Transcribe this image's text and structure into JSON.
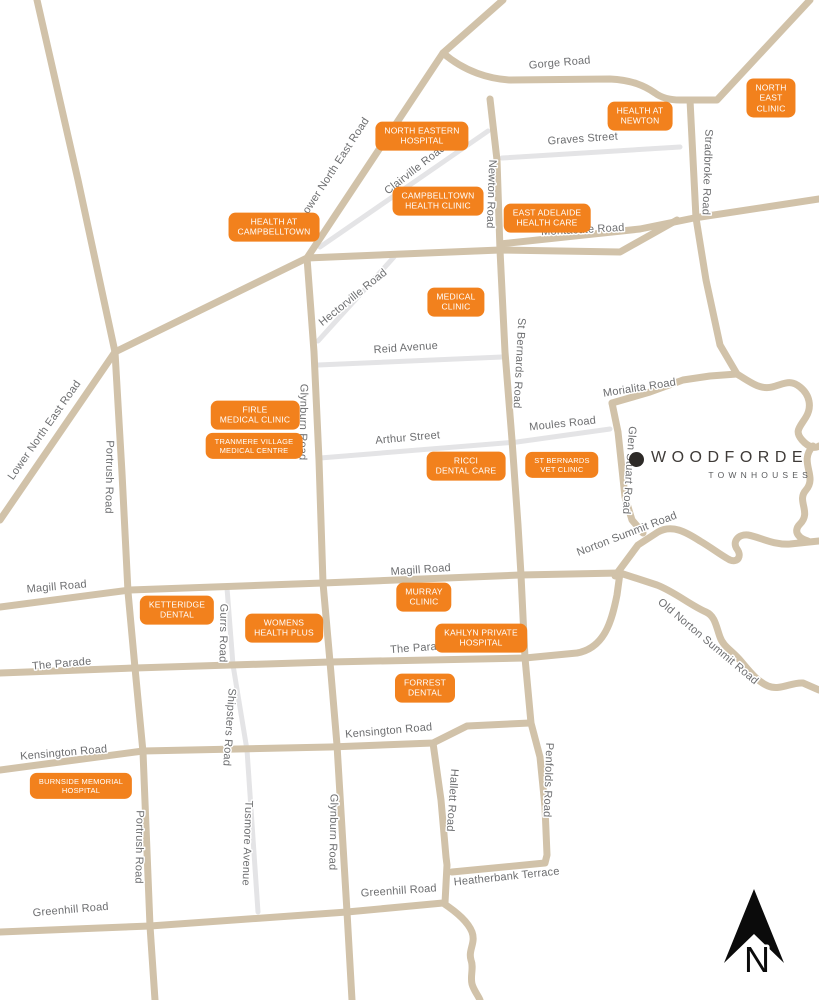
{
  "map": {
    "background_color": "#ffffff",
    "road_color": "#d1c2a9",
    "minor_road_color": "#e4e4e6",
    "road_label_color": "#6d6e70",
    "marker_color": "#f2811d",
    "marker_text_color": "#ffffff"
  },
  "logo": {
    "name": "WOODFORDE",
    "subtitle": "TOWNHOUSES"
  },
  "north_indicator": {
    "label": "N"
  },
  "road_labels": [
    {
      "id": "gorge-road",
      "text": "Gorge Road"
    },
    {
      "id": "graves-street",
      "text": "Graves Street"
    },
    {
      "id": "montacute-road",
      "text": "Montacute Road"
    },
    {
      "id": "clairville-road",
      "text": "Clairville Road"
    },
    {
      "id": "lower-north-east-road-upper",
      "text": "Lower North East Road"
    },
    {
      "id": "newton-road",
      "text": "Newton Road"
    },
    {
      "id": "stradbroke-road",
      "text": "Stradbroke Road"
    },
    {
      "id": "hectorville-road",
      "text": "Hectorville Road"
    },
    {
      "id": "reid-avenue",
      "text": "Reid Avenue"
    },
    {
      "id": "st-bernards-road",
      "text": "St Bernards Road"
    },
    {
      "id": "morialita-road",
      "text": "Morialita Road"
    },
    {
      "id": "moules-road",
      "text": "Moules Road"
    },
    {
      "id": "arthur-street",
      "text": "Arthur Street"
    },
    {
      "id": "glen-stuart-road",
      "text": "Glen Stuart Road"
    },
    {
      "id": "glynburn-road-upper",
      "text": "Glynburn Road"
    },
    {
      "id": "portrush-road-upper",
      "text": "Portrush Road"
    },
    {
      "id": "lower-north-east-road-lower",
      "text": "Lower North East Road"
    },
    {
      "id": "norton-summit-road",
      "text": "Norton Summit Road"
    },
    {
      "id": "magill-road-west",
      "text": "Magill Road"
    },
    {
      "id": "magill-road-east",
      "text": "Magill Road"
    },
    {
      "id": "old-norton-summit-road",
      "text": "Old Norton Summit Road"
    },
    {
      "id": "gurrs-road",
      "text": "Gurrs Road"
    },
    {
      "id": "the-parade-west",
      "text": "The Parade"
    },
    {
      "id": "the-parade-east",
      "text": "The Parade"
    },
    {
      "id": "shipsters-road",
      "text": "Shipsters Road"
    },
    {
      "id": "kensington-road-west",
      "text": "Kensington Road"
    },
    {
      "id": "kensington-road-east",
      "text": "Kensington Road"
    },
    {
      "id": "tusmore-avenue",
      "text": "Tusmore Avenue"
    },
    {
      "id": "hallett-road",
      "text": "Hallett Road"
    },
    {
      "id": "penfolds-road",
      "text": "Penfolds Road"
    },
    {
      "id": "glynburn-road-lower",
      "text": "Glynburn Road"
    },
    {
      "id": "portrush-road-lower",
      "text": "Portrush Road"
    },
    {
      "id": "heatherbank-terrace",
      "text": "Heatherbank Terrace"
    },
    {
      "id": "greenhill-road-west",
      "text": "Greenhill Road"
    },
    {
      "id": "greenhill-road-east",
      "text": "Greenhill Road"
    }
  ],
  "facilities": [
    {
      "id": "north-eastern-hospital",
      "name": "NORTH EASTERN\nHOSPITAL"
    },
    {
      "id": "health-at-newton",
      "name": "HEALTH AT\nNEWTON"
    },
    {
      "id": "north-east-clinic",
      "name": "NORTH EAST\nCLINIC"
    },
    {
      "id": "campbelltown-health-clinic",
      "name": "CAMPBELLTOWN\nHEALTH CLINIC"
    },
    {
      "id": "health-at-campbelltown",
      "name": "HEALTH AT\nCAMPBELLTOWN"
    },
    {
      "id": "east-adelaide-health-care",
      "name": "EAST ADELAIDE\nHEALTH CARE"
    },
    {
      "id": "medical-clinic",
      "name": "MEDICAL\nCLINIC"
    },
    {
      "id": "firle-medical-clinic",
      "name": "FIRLE\nMEDICAL CLINIC"
    },
    {
      "id": "tranmere-village-medical-centre",
      "name": "TRANMERE VILLAGE\nMEDICAL CENTRE"
    },
    {
      "id": "ricci-dental-care",
      "name": "RICCI\nDENTAL CARE"
    },
    {
      "id": "st-bernards-vet-clinic",
      "name": "ST BERNARDS\nVET CLINIC"
    },
    {
      "id": "ketteridge-dental",
      "name": "KETTERIDGE\nDENTAL"
    },
    {
      "id": "murray-clinic",
      "name": "MURRAY\nCLINIC"
    },
    {
      "id": "womens-health-plus",
      "name": "WOMENS\nHEALTH PLUS"
    },
    {
      "id": "kahlyn-private-hospital",
      "name": "KAHLYN PRIVATE\nHOSPITAL"
    },
    {
      "id": "forrest-dental",
      "name": "FORREST\nDENTAL"
    },
    {
      "id": "burnside-memorial-hospital",
      "name": "BURNSIDE MEMORIAL\nHOSPITAL"
    }
  ]
}
